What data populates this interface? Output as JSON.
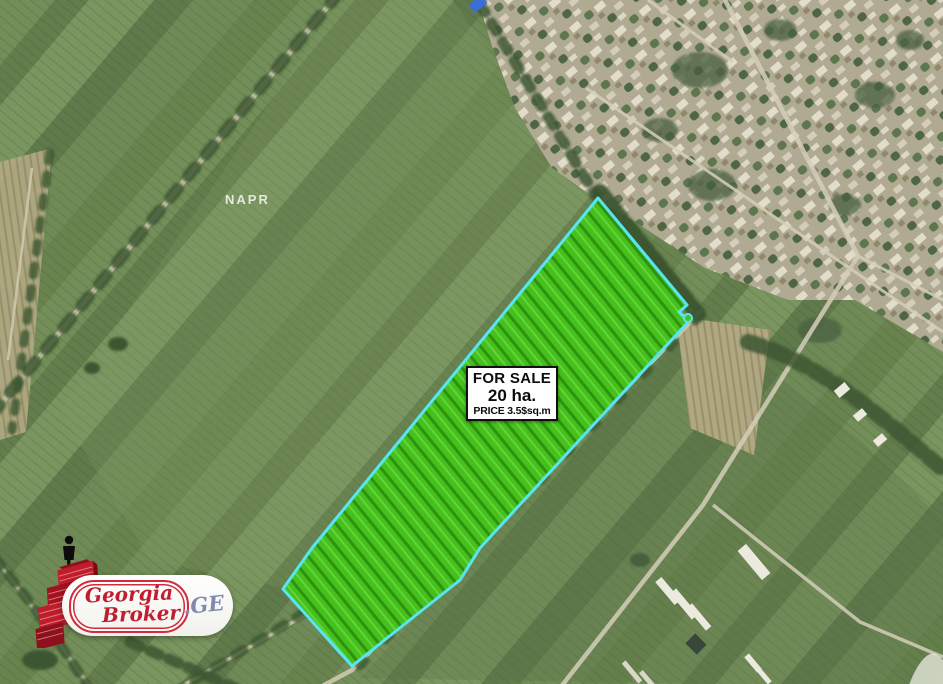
{
  "map": {
    "watermark_label": "NAPR",
    "parcel": {
      "sale_title": "FOR SALE",
      "area": "20 ha.",
      "price": "PRICE 3.5$sq.m",
      "fill_color": "#45c01c",
      "border_color": "#58e5f2"
    },
    "logo": {
      "brand_line1": "Georgia",
      "brand_line2": "Broker",
      "domain_suffix": ".GE",
      "brand_color": "#c21d2e",
      "suffix_color": "#7f88ae"
    },
    "icons": {
      "logo_person": "person-silhouette-icon",
      "logo_building": "red-building-icon",
      "watermark_wedge": "map-wedge-icon"
    }
  }
}
